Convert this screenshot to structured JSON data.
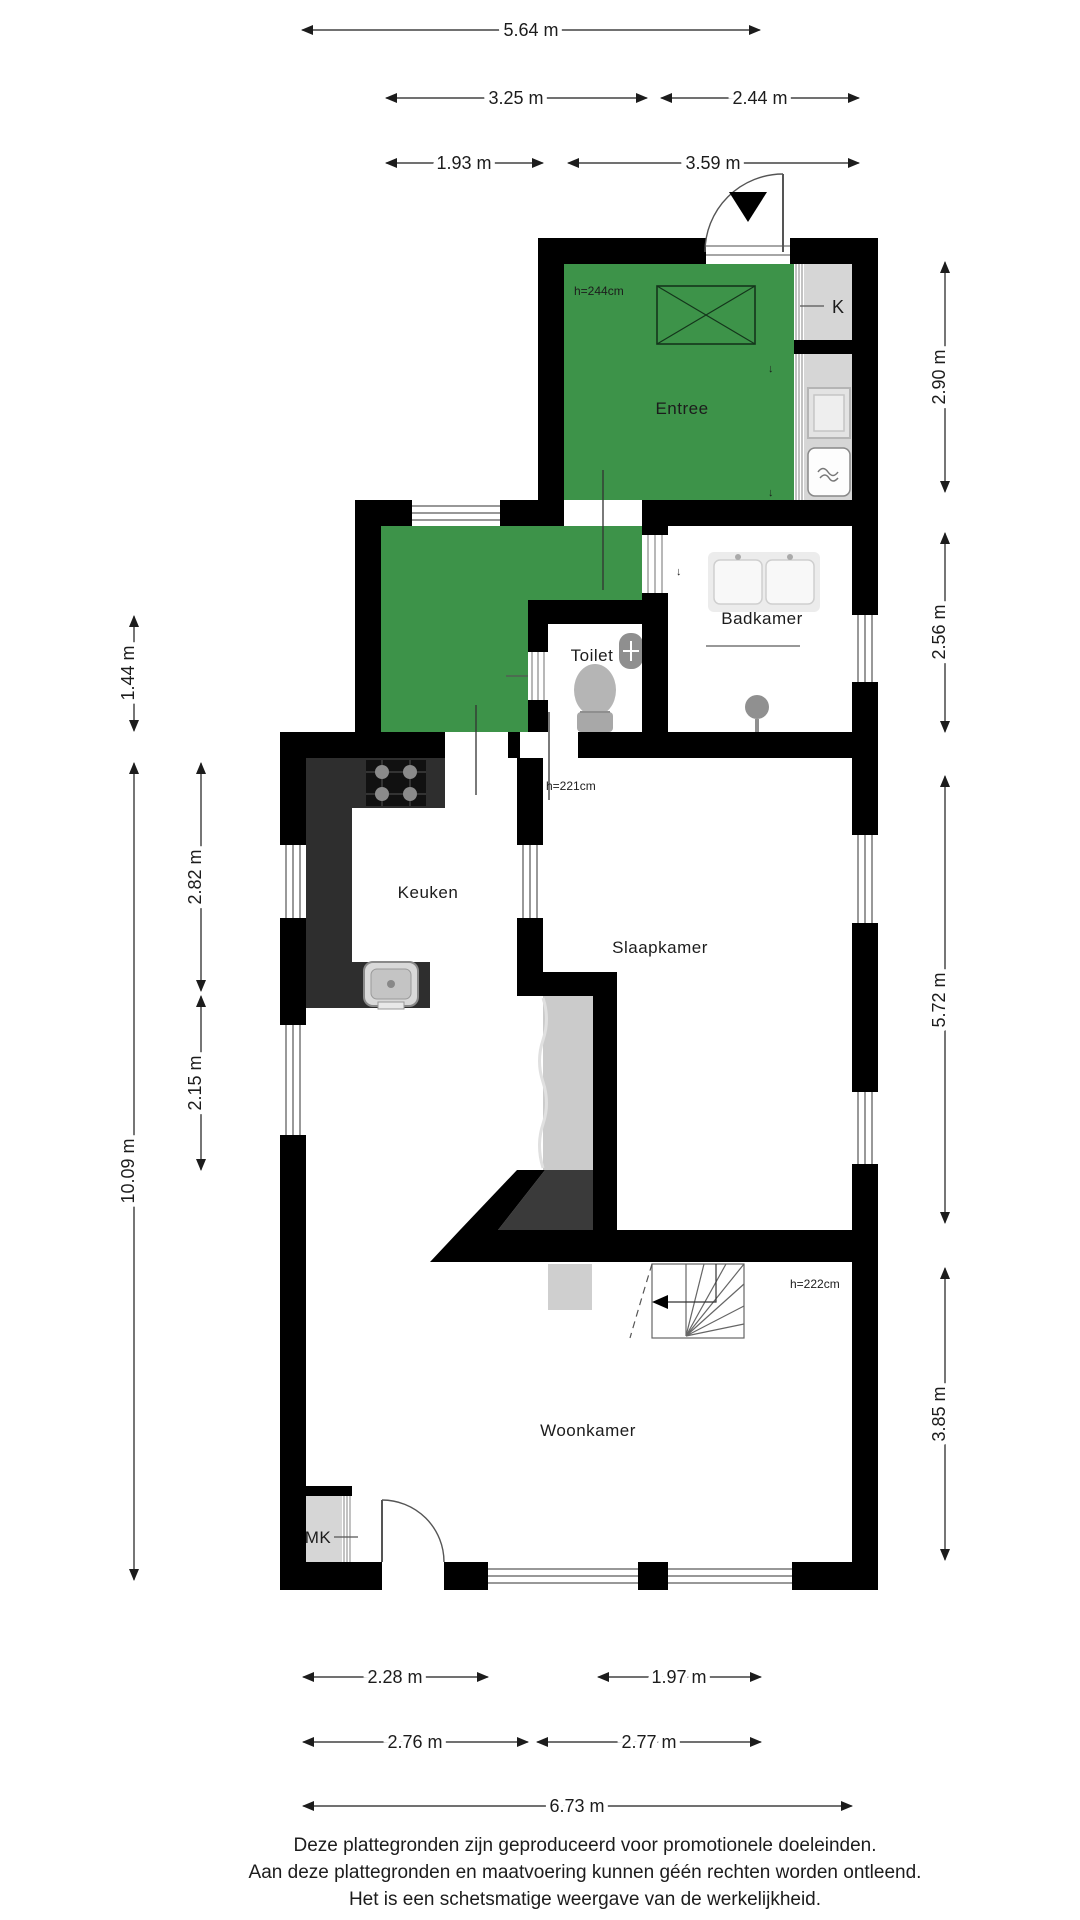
{
  "document": {
    "type": "floor-plan",
    "language": "nl"
  },
  "rooms": {
    "entree": {
      "label": "Entree",
      "ceiling_height": "h=244cm",
      "highlighted": true
    },
    "hal": {
      "label": "",
      "highlighted": true
    },
    "badkamer": {
      "label": "Badkamer"
    },
    "toilet": {
      "label": "Toilet"
    },
    "keuken": {
      "label": "Keuken"
    },
    "slaapkamer": {
      "label": "Slaapkamer",
      "ceiling_height": "h=221cm"
    },
    "woonkamer": {
      "label": "Woonkamer",
      "ceiling_height": "h=222cm"
    },
    "kast": {
      "label": "K"
    },
    "meterkast": {
      "label": "MK"
    }
  },
  "markers": {
    "down_arrow": "↓"
  },
  "dimensions": {
    "top": [
      {
        "label": "5.64 m",
        "meters": 5.64
      },
      {
        "label": "3.25 m",
        "meters": 3.25
      },
      {
        "label": "2.44 m",
        "meters": 2.44
      },
      {
        "label": "1.93 m",
        "meters": 1.93
      },
      {
        "label": "3.59 m",
        "meters": 3.59
      }
    ],
    "bottom": [
      {
        "label": "2.28 m",
        "meters": 2.28
      },
      {
        "label": "1.97 m",
        "meters": 1.97
      },
      {
        "label": "2.76 m",
        "meters": 2.76
      },
      {
        "label": "2.77 m",
        "meters": 2.77
      },
      {
        "label": "6.73 m",
        "meters": 6.73
      }
    ],
    "left": [
      {
        "label": "1.44 m",
        "meters": 1.44
      },
      {
        "label": "2.82 m",
        "meters": 2.82
      },
      {
        "label": "2.15 m",
        "meters": 2.15
      },
      {
        "label": "10.09 m",
        "meters": 10.09
      }
    ],
    "right": [
      {
        "label": "2.90 m",
        "meters": 2.9
      },
      {
        "label": "2.56 m",
        "meters": 2.56
      },
      {
        "label": "5.72 m",
        "meters": 5.72
      },
      {
        "label": "3.85 m",
        "meters": 3.85
      }
    ]
  },
  "footer": {
    "line1": "Deze plattegronden zijn geproduceerd voor promotionele doeleinden.",
    "line2": "Aan deze plattegronden en maatvoering kunnen géén rechten worden ontleend.",
    "line3": "Het is een schetsmatige weergave van de werkelijkheid."
  },
  "colors": {
    "highlight_green": "#3d9349",
    "wall_black": "#000000",
    "counter_dark": "#2e2e2e",
    "ramp_dark": "#3a3a3a",
    "closet_grey": "#d6d6d6",
    "stair_grey": "#cbcbcb",
    "fixture_grey": "#b3b3b3",
    "background": "#ffffff"
  }
}
